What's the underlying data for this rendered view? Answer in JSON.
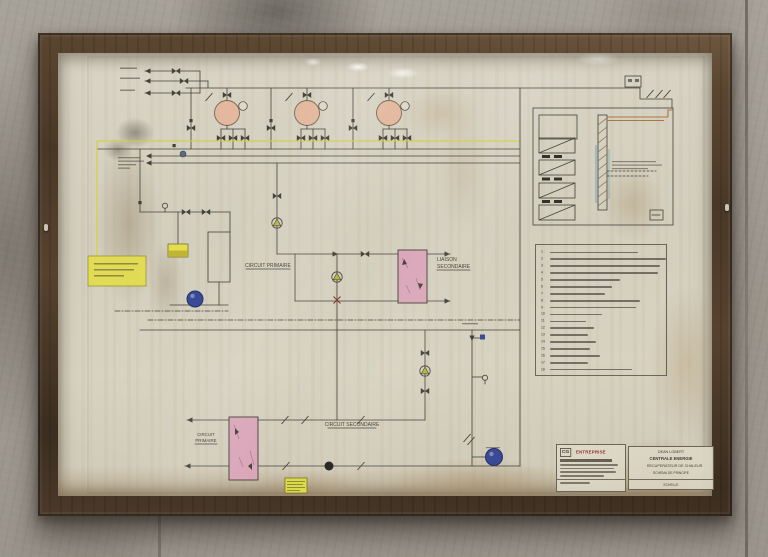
{
  "labels": {
    "circuit_primaire_upper": "CIRCUIT PRIMAIRE",
    "liaison_secondaire_l1": "LIAISON",
    "liaison_secondaire_l2": "SECONDAIRE",
    "circuit_primaire_lower_l1": "CIRCUIT",
    "circuit_primaire_lower_l2": "PRIMAIRE",
    "circuit_secondaire": "CIRCUIT SECONDAIRE"
  },
  "legend": {
    "items": [
      {
        "n": "1",
        "w": 88
      },
      {
        "n": "2",
        "w": 116
      },
      {
        "n": "3",
        "w": 110
      },
      {
        "n": "4",
        "w": 108
      },
      {
        "n": "5",
        "w": 70
      },
      {
        "n": "6",
        "w": 62
      },
      {
        "n": "7",
        "w": 55
      },
      {
        "n": "8",
        "w": 90
      },
      {
        "n": "9",
        "w": 86
      },
      {
        "n": "10",
        "w": 52
      },
      {
        "n": "11",
        "w": 36
      },
      {
        "n": "12",
        "w": 44
      },
      {
        "n": "13",
        "w": 38
      },
      {
        "n": "14",
        "w": 46
      },
      {
        "n": "15",
        "w": 40
      },
      {
        "n": "16",
        "w": 50
      },
      {
        "n": "17",
        "w": 38
      },
      {
        "n": "18",
        "w": 82
      }
    ]
  },
  "stamps": {
    "contractor": {
      "logo": "CG",
      "name": "ENTREPRISE"
    },
    "title_block": {
      "l1": "DEAN LOBERT",
      "l2": "CENTRALE ENERGIE",
      "l3": "RECUPERATEUR DE CHALEUR",
      "l4": "SCHEMA DE PRINCIPE",
      "footer": "ECHELLE"
    }
  },
  "colors": {
    "ink": "#43423a",
    "accent_yellow": "#ddd843",
    "exchanger_pink": "#d9a6b8",
    "pump_blue": "#3b4a97",
    "boiler_salmon": "#e3b89e",
    "duct_brown": "#b07442"
  }
}
